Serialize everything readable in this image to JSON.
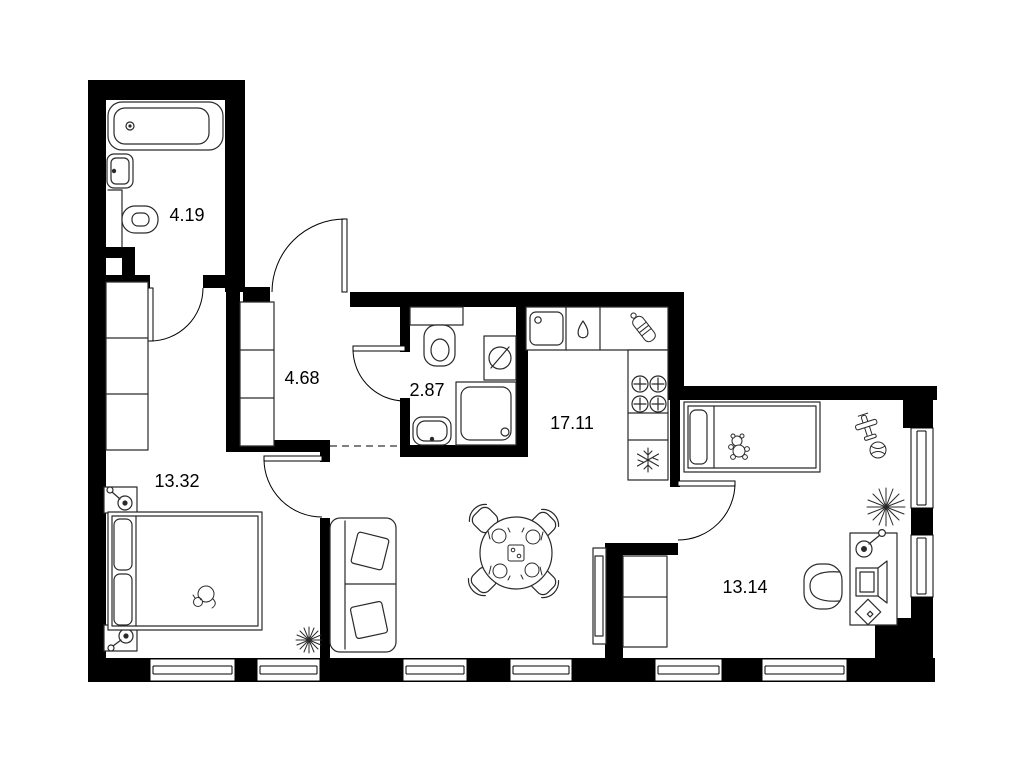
{
  "floor_plan": {
    "title": "apartment-floor-plan",
    "colors": {
      "wall": "#000000",
      "background": "#ffffff",
      "line": "#2a2a2a"
    },
    "rooms": {
      "bathroom": {
        "name": "bathroom",
        "label": "4.19"
      },
      "hallway": {
        "name": "hallway",
        "label": "4.68"
      },
      "toilet": {
        "name": "toilet-room",
        "label": "2.87"
      },
      "kitchen_living": {
        "name": "kitchen-living-room",
        "label": "17.11"
      },
      "bedroom": {
        "name": "bedroom",
        "label": "13.32"
      },
      "child_room": {
        "name": "child-room",
        "label": "13.14"
      }
    },
    "icons": [
      "bathtub-icon",
      "sink-icon",
      "toilet-icon",
      "washing-machine-icon",
      "shower-icon",
      "kitchen-sink-icon",
      "water-drop-icon",
      "bottle-icon",
      "stove-icon",
      "fridge-snowflake-icon",
      "wardrobe-icon",
      "double-bed-icon",
      "cat-icon",
      "lamp-icon",
      "sofa-icon",
      "pillow-icon",
      "dining-table-icon",
      "chair-icon",
      "tv-console-icon",
      "single-bed-icon",
      "teddy-bear-icon",
      "desk-icon",
      "monitor-icon",
      "desk-chair-icon",
      "toy-plane-icon",
      "ball-icon",
      "plant-icon",
      "door-swing-icon",
      "window-icon"
    ]
  }
}
